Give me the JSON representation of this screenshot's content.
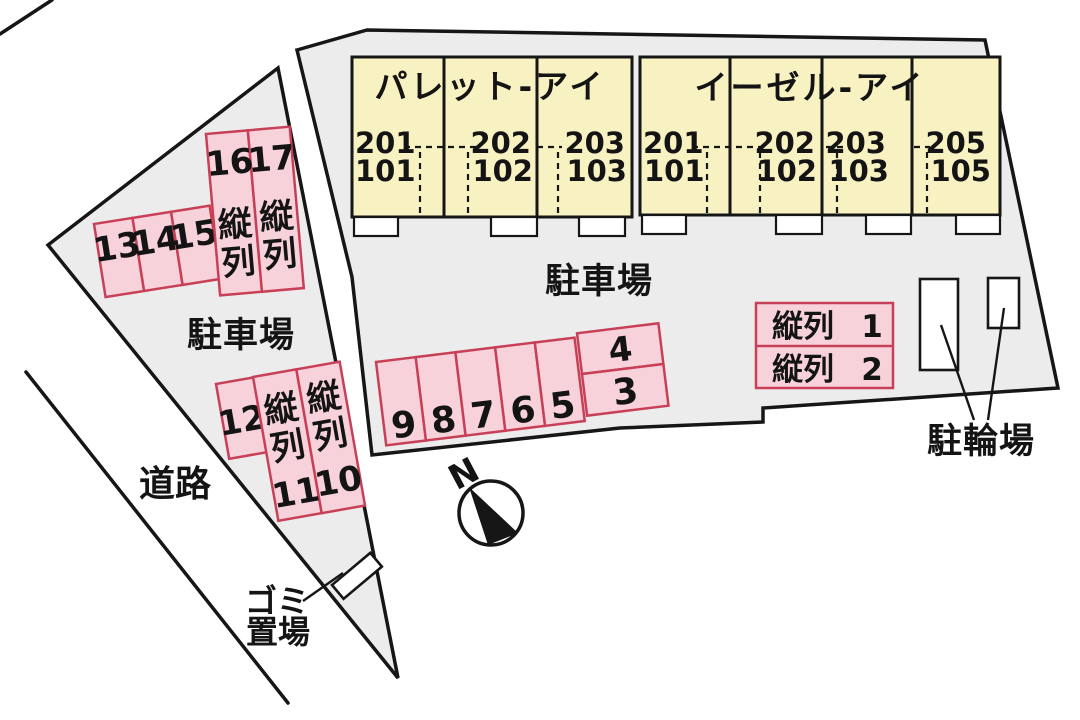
{
  "buildings": [
    {
      "name": "パレット-アイ",
      "units": [
        {
          "upper": "201",
          "lower": "101"
        },
        {
          "upper": "202",
          "lower": "102"
        },
        {
          "upper": "203",
          "lower": "103"
        }
      ]
    },
    {
      "name": "イーゼル-アイ",
      "units": [
        {
          "upper": "201",
          "lower": "101"
        },
        {
          "upper": "202",
          "lower": "102"
        },
        {
          "upper": "203",
          "lower": "103"
        },
        {
          "upper": "205",
          "lower": "105"
        }
      ]
    }
  ],
  "areas": {
    "parking_left": "駐車場",
    "parking_main": "駐車場",
    "road": "道路",
    "bicycle_parking": "駐輪場",
    "garbage": [
      "ゴミ",
      "置場"
    ]
  },
  "compass": {
    "north": "N"
  },
  "spaces": {
    "row13": [
      "13",
      "14",
      "15"
    ],
    "tandem1617": {
      "numbers": [
        "16",
        "17"
      ],
      "label_chars": [
        "縦",
        "列"
      ]
    },
    "space12": "12",
    "tandem1011": {
      "numbers": [
        "11",
        "10"
      ],
      "label_chars": [
        "縦",
        "列"
      ]
    },
    "row59": [
      "9",
      "8",
      "7",
      "6",
      "5"
    ],
    "stack34": [
      "4",
      "3"
    ],
    "tandem_table": {
      "rows": [
        {
          "label": "縦列",
          "number": "1"
        },
        {
          "label": "縦列",
          "number": "2"
        }
      ]
    }
  },
  "colors": {
    "site_fill": "#ececec",
    "building_fill": "#f8f2c2",
    "space_fill": "#f7d2da",
    "space_stroke": "#c84058",
    "line": "#161616",
    "bg": "#ffffff"
  }
}
